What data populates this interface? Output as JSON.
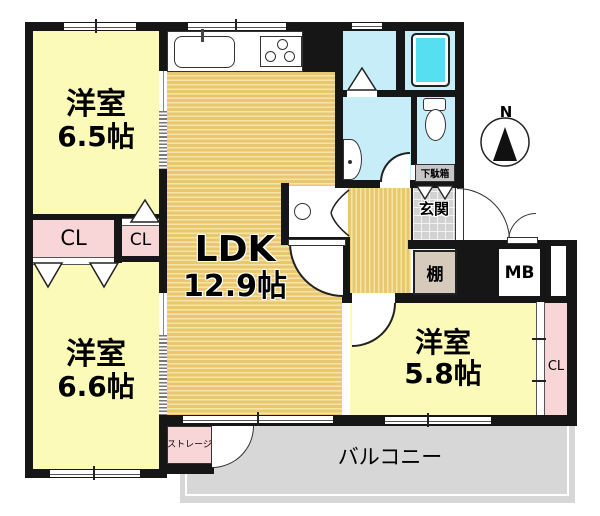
{
  "rooms": {
    "bedroom_nw": {
      "label": "洋室",
      "area": "6.5帖"
    },
    "ldk": {
      "label": "LDK",
      "area": "12.9帖"
    },
    "bedroom_sw": {
      "label": "洋室",
      "area": "6.6帖"
    },
    "bedroom_se": {
      "label": "洋室",
      "area": "5.8帖"
    }
  },
  "labels": {
    "closet_nw": "CL",
    "closet_nw_small": "CL",
    "closet_se": "CL",
    "entrance": "玄関",
    "shoe_cabinet": "下駄箱",
    "shelf": "棚",
    "meter_box": "MB",
    "balcony": "バルコニー",
    "storage": "ストレージ",
    "compass_north": "N"
  },
  "colors": {
    "wall": "#161616",
    "bedroom_fill": "#fcfab8",
    "flooring": "#e9c770",
    "flooring_stripe": "#f4e5a6",
    "closet_pink": "#f8d6d8",
    "wet_area_blue": "#c6edf8",
    "bathtub_cyan": "#55dff0",
    "entrance_tile": "#d2d2d2",
    "balcony_gray": "#d7d7d7",
    "shelf_beige": "#d5cabb"
  }
}
